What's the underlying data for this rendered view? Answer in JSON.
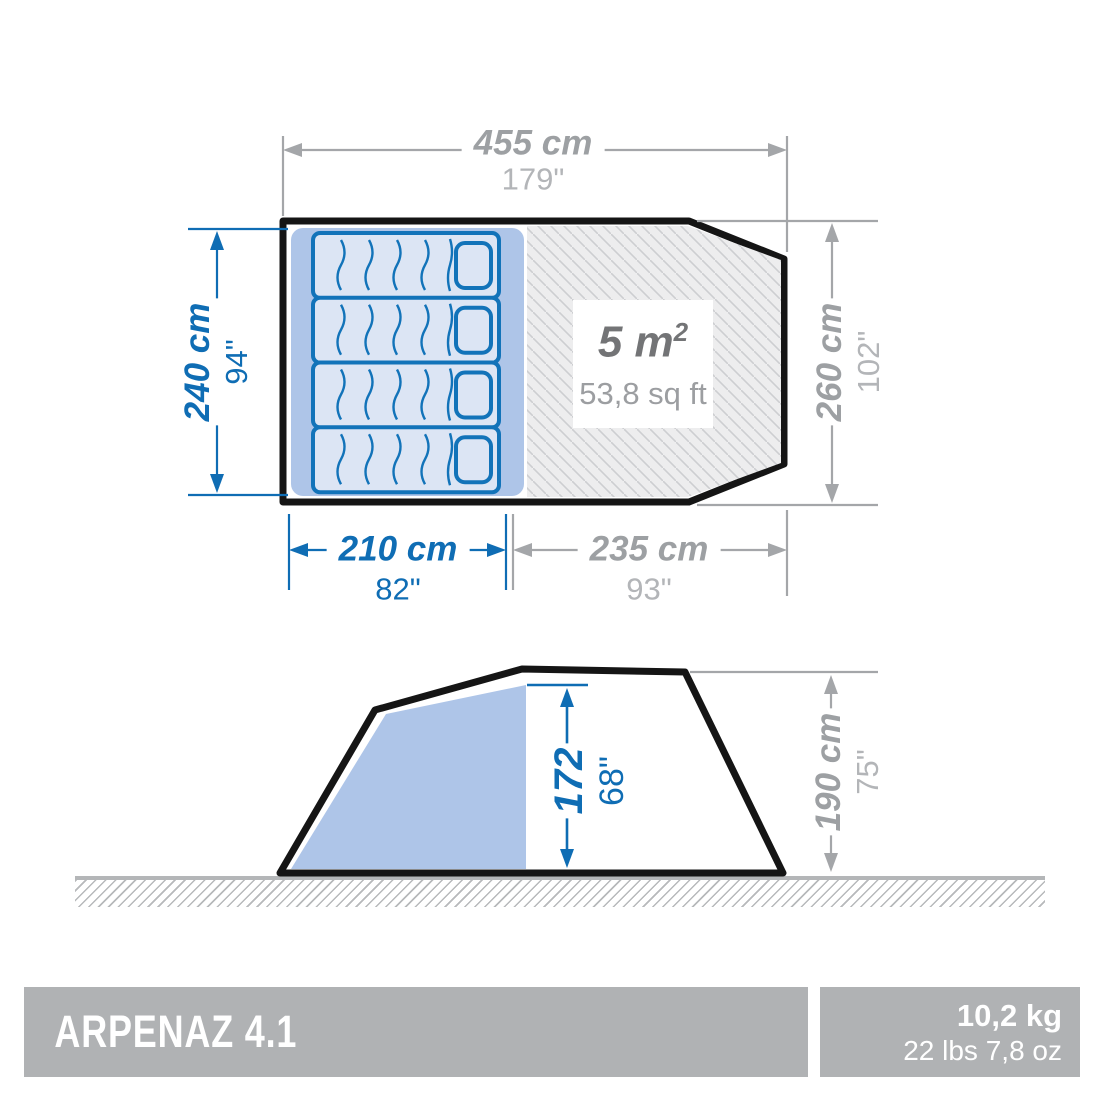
{
  "top_view": {
    "total_width": {
      "cm": "455 cm",
      "in": "179\""
    },
    "total_depth": {
      "cm": "260 cm",
      "in": "102\""
    },
    "bedroom_depth": {
      "cm": "240 cm",
      "in": "94\""
    },
    "bedroom_width": {
      "cm": "210 cm",
      "in": "82\""
    },
    "living_width": {
      "cm": "235 cm",
      "in": "93\""
    },
    "living_area": {
      "metric": "5 m",
      "metric_sup": "2",
      "imperial": "53,8 sq ft"
    }
  },
  "side_view": {
    "interior_height": {
      "cm": "172",
      "in": "68\""
    },
    "total_height": {
      "cm": "190 cm",
      "in": "75\""
    }
  },
  "footer": {
    "product_name": "ARPENAZ 4.1",
    "weight_metric": "10,2 kg",
    "weight_imperial": "22 lbs 7,8 oz"
  },
  "colors": {
    "dimension_blue": "#0f6db4",
    "dimension_gray": "#a4a6a9",
    "cabin_fill": "#aec5e8",
    "mattress_fill": "#dce5f4",
    "outline_black": "#151515",
    "footer_bar_gray": "#b0b2b4"
  }
}
